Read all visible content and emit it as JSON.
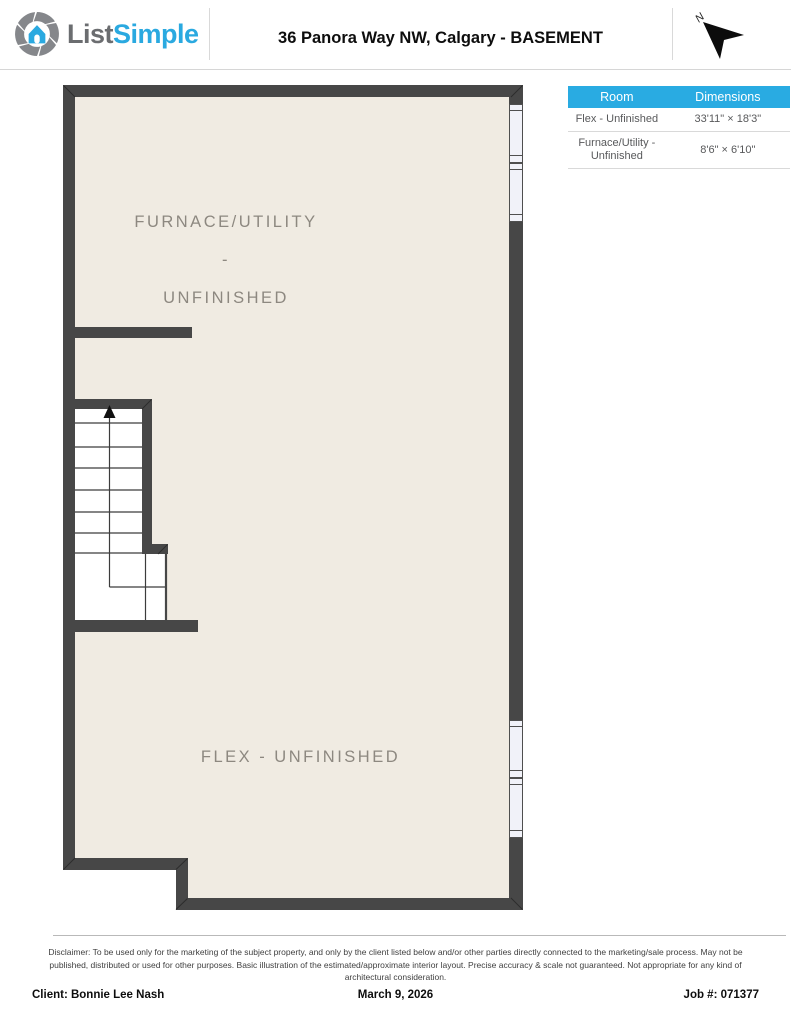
{
  "header": {
    "logo": {
      "part1": "List",
      "part2": "Simple",
      "icon": "aperture-house-icon"
    },
    "title": "36 Panora Way NW, Calgary - BASEMENT",
    "compass_label": "N"
  },
  "table": {
    "columns": {
      "room": "Room",
      "dimensions": "Dimensions"
    },
    "rows": [
      {
        "room": "Flex - Unfinished",
        "dimensions": "33'11\" × 18'3\""
      },
      {
        "room": "Furnace/Utility - Unfinished",
        "dimensions": "8'6\" × 6'10\""
      }
    ]
  },
  "floorplan": {
    "furnace_label": {
      "line1": "FURNACE/UTILITY -",
      "line2": "UNFINISHED"
    },
    "flex_label": "FLEX - UNFINISHED",
    "features": [
      "staircase-with-up-arrow",
      "two-windows-upper-right-wall",
      "two-windows-lower-right-wall"
    ],
    "colors": {
      "wall": "#474747",
      "floor": "#f0ebe2",
      "stair_area": "#ffffff",
      "window_fill": "#f1f2f9",
      "table_header_bg": "#29abe2",
      "logo_gray": "#6b6d70",
      "logo_blue": "#2aa9e0"
    }
  },
  "disclaimer": "Disclaimer: To be used only for the marketing of the subject property, and only by the client listed below and/or other parties directly connected to the marketing/sale process. May not be published, distributed or used for other purposes. Basic illustration of the estimated/approximate interior layout. Precise accuracy & scale not guaranteed. Not appropriate for any kind of architectural consideration.",
  "footer": {
    "client": "Client: Bonnie Lee Nash",
    "date": "March 9, 2026",
    "job": "Job #: 071377"
  }
}
